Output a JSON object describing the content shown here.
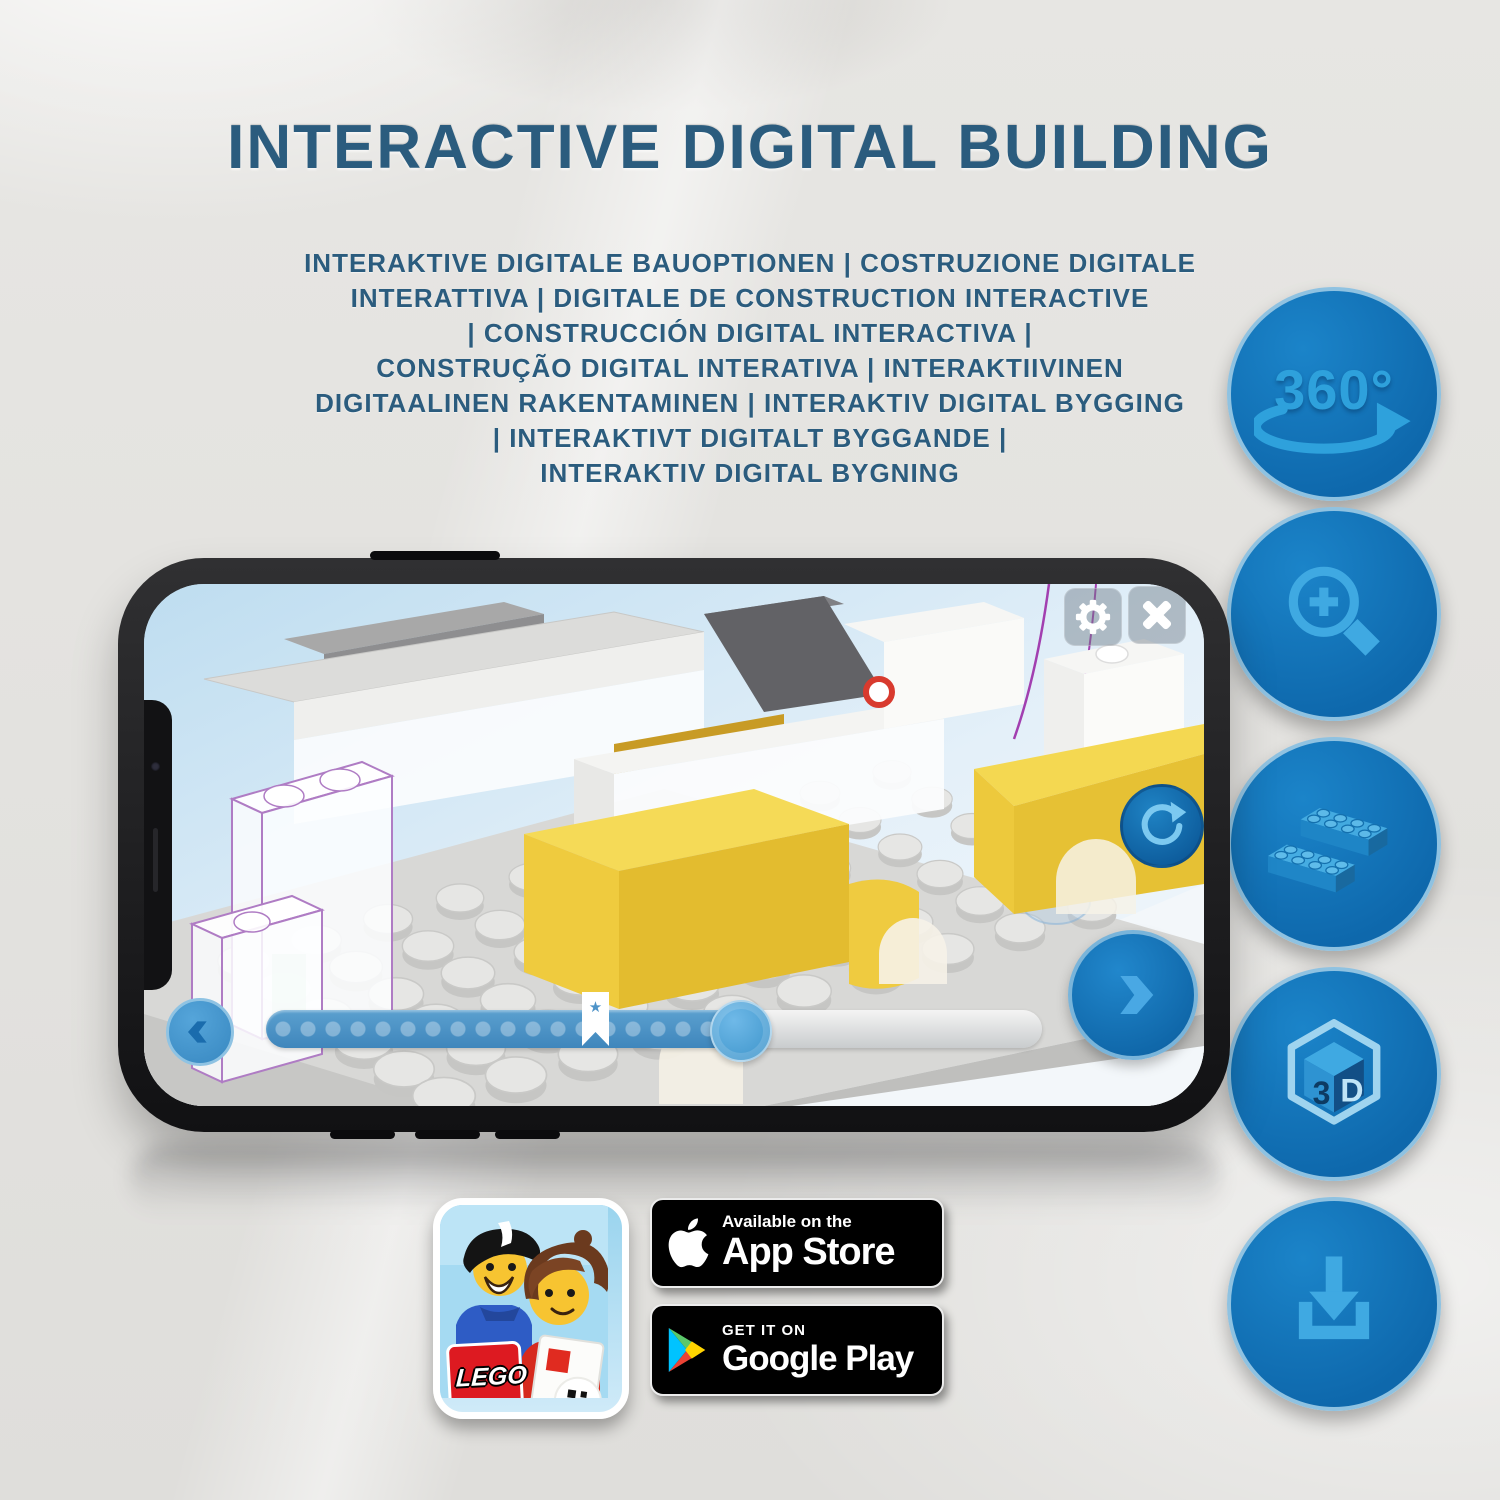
{
  "header": {
    "title": "INTERACTIVE DIGITAL BUILDING",
    "title_color": "#2B5C7E",
    "subtitle_lines": [
      "INTERAKTIVE DIGITALE BAUOPTIONEN | COSTRUZIONE DIGITALE",
      "INTERATTIVA | DIGITALE DE CONSTRUCTION INTERACTIVE",
      "| CONSTRUCCIÓN DIGITAL INTERACTIVA |",
      "CONSTRUÇÃO DIGITAL INTERATIVA | INTERAKTIIVINEN",
      "DIGITAALINEN RAKENTAMINEN | INTERAKTIV DIGITAL BYGGING",
      "| INTERAKTIVT DIGITALT BYGGANDE |",
      "INTERAKTIV DIGITAL BYGNING"
    ]
  },
  "feature_icons": {
    "badge_color": "#0F6FB4",
    "border_color": "#8FC2E1",
    "glyph_color": "#3FA9E2",
    "items": [
      {
        "name": "rotate-360-icon",
        "label": "360°"
      },
      {
        "name": "zoom-in-icon"
      },
      {
        "name": "bricks-icon"
      },
      {
        "name": "cube-3d-icon",
        "label_left": "3",
        "label_right": "D"
      },
      {
        "name": "download-icon"
      }
    ]
  },
  "phone": {
    "app_ui": {
      "progress_percent": 61,
      "bookmark_star_present": true,
      "highlight_brick_color": "#F2D54E",
      "screen_background": "#D6EAF7"
    }
  },
  "app_icon": {
    "logo_text": "LEGO"
  },
  "store_badges": {
    "app_store": {
      "tagline": "Available on the",
      "store": "App Store"
    },
    "google_play": {
      "tagline": "GET IT ON",
      "store": "Google Play"
    }
  }
}
